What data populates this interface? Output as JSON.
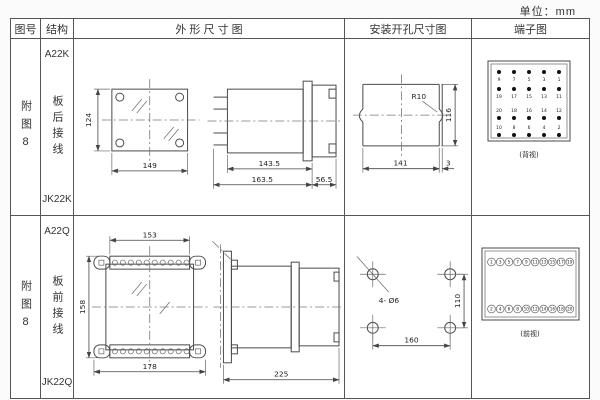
{
  "unit_label": "单位：mm",
  "table": {
    "headers": {
      "figure": "图号",
      "structure": "结构",
      "outline": "外 形 尺 寸 图",
      "install": "安装开孔尺寸图",
      "terminal": "端子图"
    },
    "rows": [
      {
        "figure_no": "附图8",
        "structure_top": "A22K",
        "structure_mid": "板后接线",
        "structure_bottom": "JK22K",
        "outline_dims": {
          "front_height": "124",
          "front_width": "149",
          "body_depth": "143.5",
          "total_depth": "163.5",
          "rear_depth": "56.5"
        },
        "install_dims": {
          "radius": "R10",
          "width": "141",
          "height": "116",
          "edge": "3"
        },
        "terminal": {
          "grid": [
            [
              "9",
              "7",
              "5",
              "3",
              "1"
            ],
            [
              "19",
              "17",
              "15",
              "13",
              "11"
            ],
            [
              "20",
              "18",
              "16",
              "14",
              "12"
            ],
            [
              "10",
              "8",
              "6",
              "4",
              "2"
            ]
          ],
          "caption": "(背视)"
        }
      },
      {
        "figure_no": "附图8",
        "structure_top": "A22Q",
        "structure_mid": "板前接线",
        "structure_bottom": "JK22Q",
        "outline_dims": {
          "front_top_width": "153",
          "front_height": "158",
          "front_bottom_width": "178",
          "depth": "225"
        },
        "install_dims": {
          "holes": "4- Ø6",
          "height": "110",
          "width": "160"
        },
        "terminal": {
          "top": [
            "1",
            "3",
            "5",
            "7",
            "9",
            "11",
            "13",
            "15",
            "17",
            "19"
          ],
          "bottom": [
            "2",
            "4",
            "6",
            "8",
            "10",
            "12",
            "14",
            "16",
            "18",
            "20"
          ],
          "caption": "(前视)"
        }
      }
    ]
  }
}
